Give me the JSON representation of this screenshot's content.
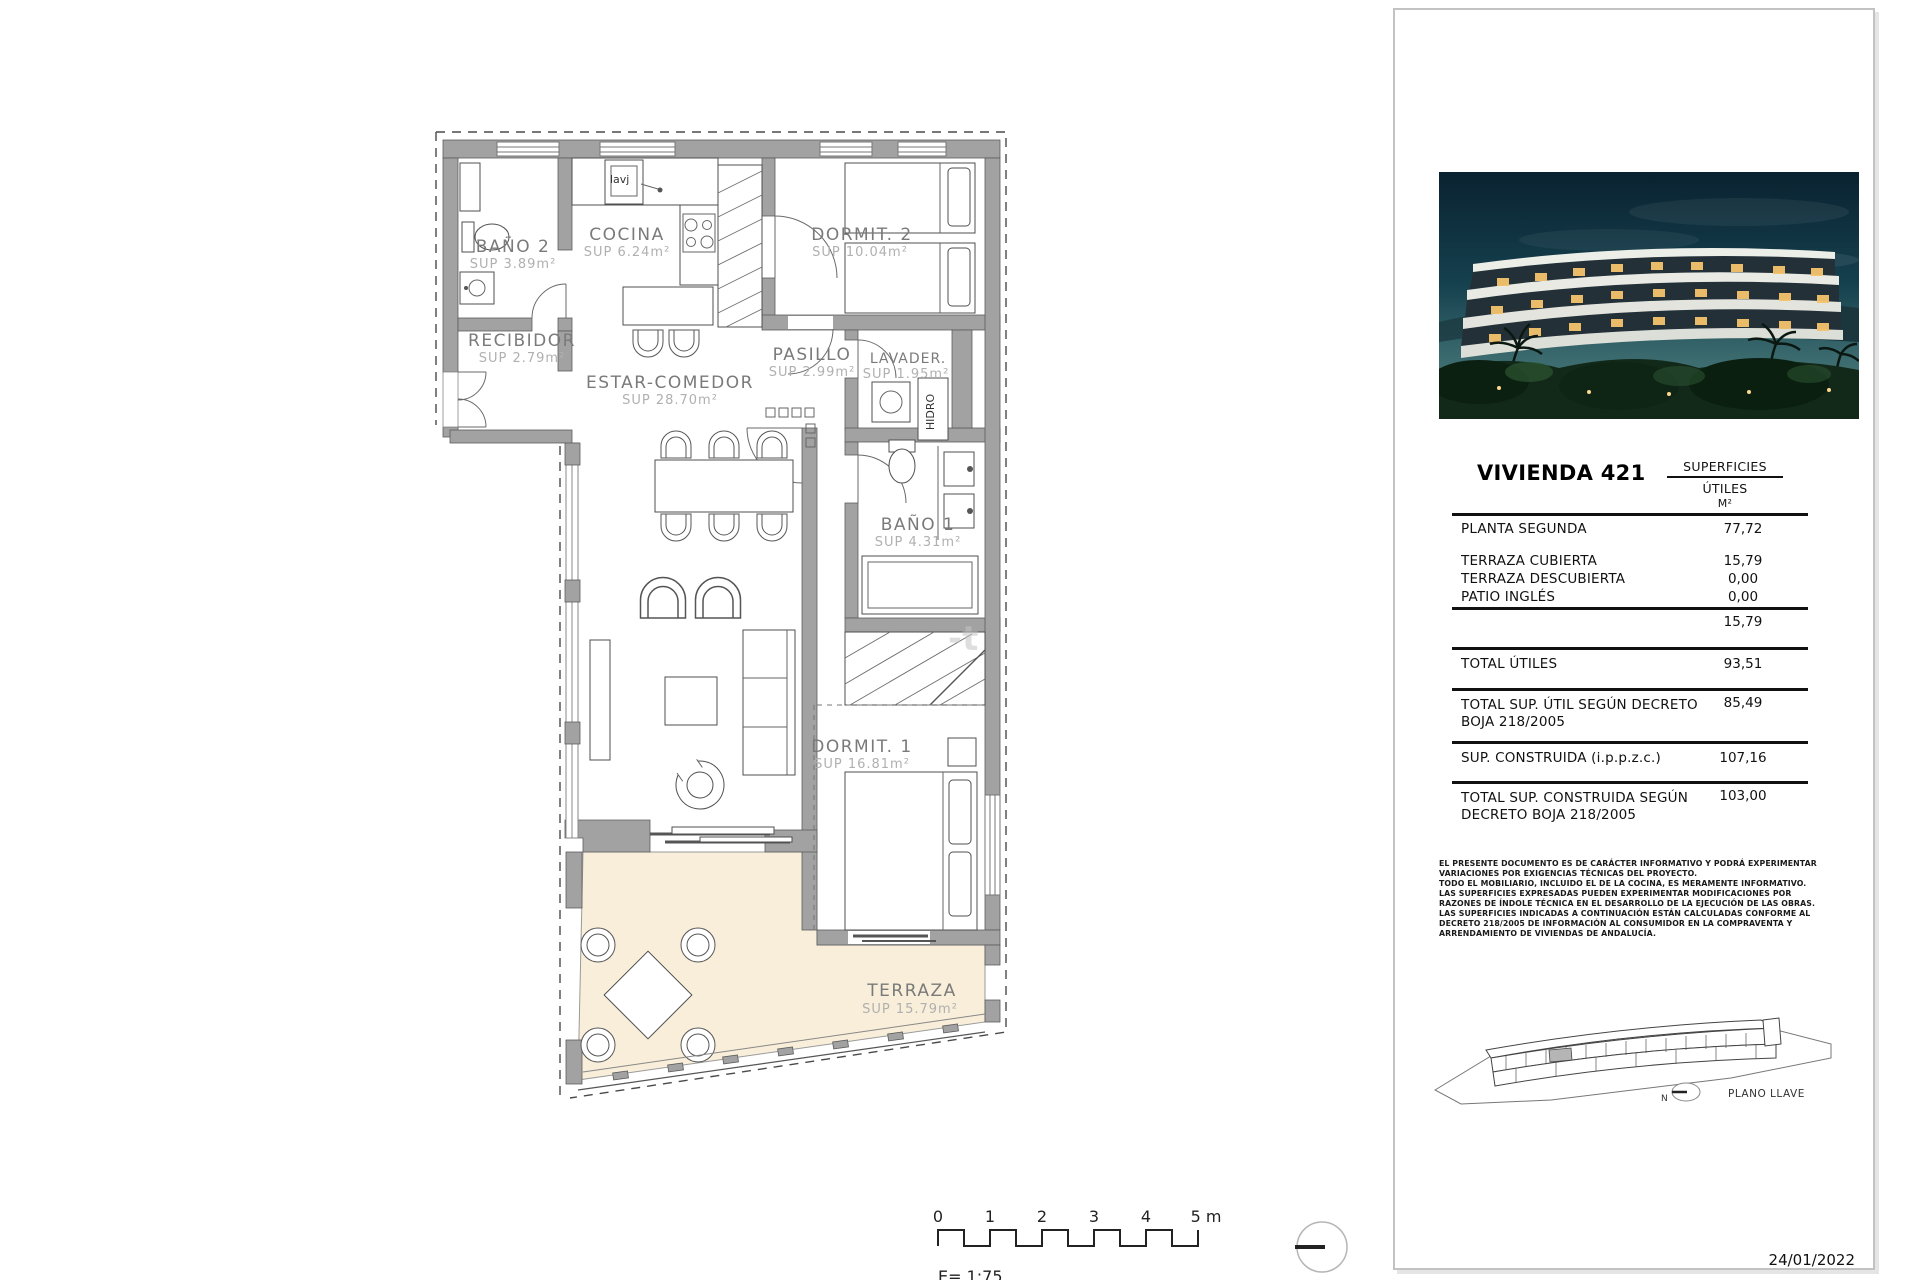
{
  "plan": {
    "rooms": {
      "bano2": {
        "name": "BAÑO 2",
        "sup": "SUP 3.89m²"
      },
      "cocina": {
        "name": "COCINA",
        "sup": "SUP 6.24m²"
      },
      "dormit2": {
        "name": "DORMIT. 2",
        "sup": "SUP 10.04m²"
      },
      "recibidor": {
        "name": "RECIBIDOR",
        "sup": "SUP 2.79m²"
      },
      "pasillo": {
        "name": "PASILLO",
        "sup": "SUP 2.99m²"
      },
      "lavadero": {
        "name": "LAVADER.",
        "sup": "SUP 1.95m²"
      },
      "estar": {
        "name": "ESTAR-COMEDOR",
        "sup": "SUP 28.70m²"
      },
      "bano1": {
        "name": "BAÑO 1",
        "sup": "SUP 4.31m²"
      },
      "dormit1": {
        "name": "DORMIT. 1",
        "sup": "SUP 16.81m²"
      },
      "terraza": {
        "name": "TERRAZA",
        "sup": "SUP 15.79m²"
      }
    },
    "annotations": {
      "sink_label": "lavj",
      "hidro_label": "HIDRO",
      "watermark": "-t"
    }
  },
  "scale_bar": {
    "ticks": [
      "0",
      "1",
      "2",
      "3",
      "4",
      "5 m"
    ],
    "scale_text": "E= 1:75"
  },
  "panel": {
    "title": "VIVIENDA 421",
    "table": {
      "col_header": "SUPERFICIES",
      "col_sub1": "ÚTILES",
      "col_sub2": "M²",
      "rows": [
        {
          "label": "PLANTA SEGUNDA",
          "value": "77,72"
        },
        {
          "label": "TERRAZA CUBIERTA",
          "value": "15,79"
        },
        {
          "label": "TERRAZA DESCUBIERTA",
          "value": "0,00"
        },
        {
          "label": "PATIO INGLÉS",
          "value": "0,00"
        }
      ],
      "subtotal": "15,79",
      "totals": [
        {
          "label": "TOTAL ÚTILES",
          "value": "93,51"
        },
        {
          "label": "TOTAL SUP. ÚTIL SEGÚN DECRETO BOJA 218/2005",
          "value": "85,49"
        },
        {
          "label": "SUP. CONSTRUIDA (i.p.p.z.c.)",
          "value": "107,16"
        },
        {
          "label": "TOTAL SUP. CONSTRUIDA SEGÚN DECRETO BOJA 218/2005",
          "value": "103,00"
        }
      ]
    },
    "disclaimer": [
      "EL PRESENTE DOCUMENTO ES DE CARÁCTER INFORMATIVO Y PODRÁ EXPERIMENTAR VARIACIONES POR EXIGENCIAS TÉCNICAS DEL PROYECTO.",
      "TODO EL MOBILIARIO, INCLUIDO EL DE LA COCINA, ES MERAMENTE INFORMATIVO.",
      "LAS SUPERFICIES EXPRESADAS PUEDEN EXPERIMENTAR MODIFICACIONES POR RAZONES DE ÍNDOLE TÉCNICA EN EL DESARROLLO DE LA EJECUCIÓN DE LAS OBRAS.",
      "LAS SUPERFICIES INDICADAS A CONTINUACIÓN ESTÁN CALCULADAS CONFORME AL DECRETO 218/2005 DE INFORMACIÓN AL CONSUMIDOR EN LA COMPRAVENTA Y ARRENDAMIENTO DE VIVIENDAS DE ANDALUCÍA."
    ],
    "key_plan": {
      "label": "PLANO LLAVE",
      "north": "N"
    },
    "date": "24/01/2022"
  },
  "colors": {
    "wall": "#a2a2a2",
    "terrace": "#f8eed9",
    "line": "#111111",
    "night_sky": "#0a2230"
  }
}
